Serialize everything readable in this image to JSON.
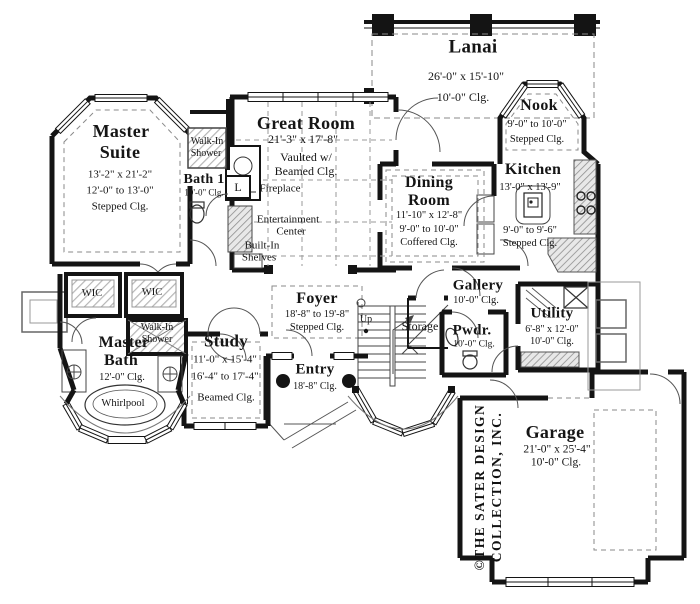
{
  "plan": {
    "lanai": {
      "name": "Lanai",
      "dims": "26'-0\" x 15'-10\"",
      "clg": "10'-0\" Clg."
    },
    "nook": {
      "name": "Nook",
      "dims": "9'-0\" to 10'-0\"",
      "clg": "Stepped Clg."
    },
    "master_suite": {
      "name1": "Master",
      "name2": "Suite",
      "dims": "13'-2\" x 21'-2\"",
      "clg1": "12'-0\" to 13'-0\"",
      "clg2": "Stepped Clg."
    },
    "bath1": {
      "name": "Bath 1",
      "clg": "10'-0\" Clg.",
      "shower1": "Walk-In",
      "shower2": "Shower",
      "linen": "L"
    },
    "great_room": {
      "name": "Great Room",
      "dims": "21'-3\" x 17'-8\"",
      "clg1": "Vaulted w/",
      "clg2": "Beamed Clg.",
      "fireplace": "Fireplace",
      "ent1": "Entertainment",
      "ent2": "Center",
      "shelves1": "Built-In",
      "shelves2": "Shelves"
    },
    "dining": {
      "name1": "Dining",
      "name2": "Room",
      "dims": "11'-10\" x 12'-8\"",
      "clg1": "9'-0\" to 10'-0\"",
      "clg2": "Coffered Clg."
    },
    "kitchen": {
      "name": "Kitchen",
      "dims": "13'-0\" x 13'-9\"",
      "clg1": "9'-0\" to 9'-6\"",
      "clg2": "Stepped Clg."
    },
    "gallery": {
      "name": "Gallery",
      "clg": "10'-0\" Clg."
    },
    "foyer": {
      "name": "Foyer",
      "dims": "18'-8\" to 19'-8\"",
      "clg": "Stepped Clg."
    },
    "stairs": {
      "up": "Up",
      "storage": "Storage"
    },
    "pwdr": {
      "name": "Pwdr.",
      "clg": "10'-0\" Clg."
    },
    "utility": {
      "name": "Utility",
      "dims": "6'-8\" x 12'-0\"",
      "clg": "10'-0\" Clg."
    },
    "master_bath": {
      "name1": "Master",
      "name2": "Bath",
      "clg": "12'-0\" Clg.",
      "wic": "WIC",
      "shower1": "Walk-In",
      "shower2": "Shower",
      "whirlpool": "Whirlpool"
    },
    "study": {
      "name": "Study",
      "dims": "11'-0\" x 15'-4\"",
      "clg1": "16'-4\" to 17'-4\"",
      "clg2": "Beamed Clg."
    },
    "entry": {
      "name": "Entry",
      "clg": "18'-8\" Clg."
    },
    "garage": {
      "name": "Garage",
      "dims": "21'-0\" x 25'-4\"",
      "clg": "10'-0\" Clg."
    },
    "branding": {
      "line1": "©THE SATER DESIGN",
      "line2": "COLLECTION, INC."
    },
    "colors": {
      "wall": "#141414",
      "dash": "#8a8a8a",
      "thin": "#3a3a3a"
    }
  }
}
